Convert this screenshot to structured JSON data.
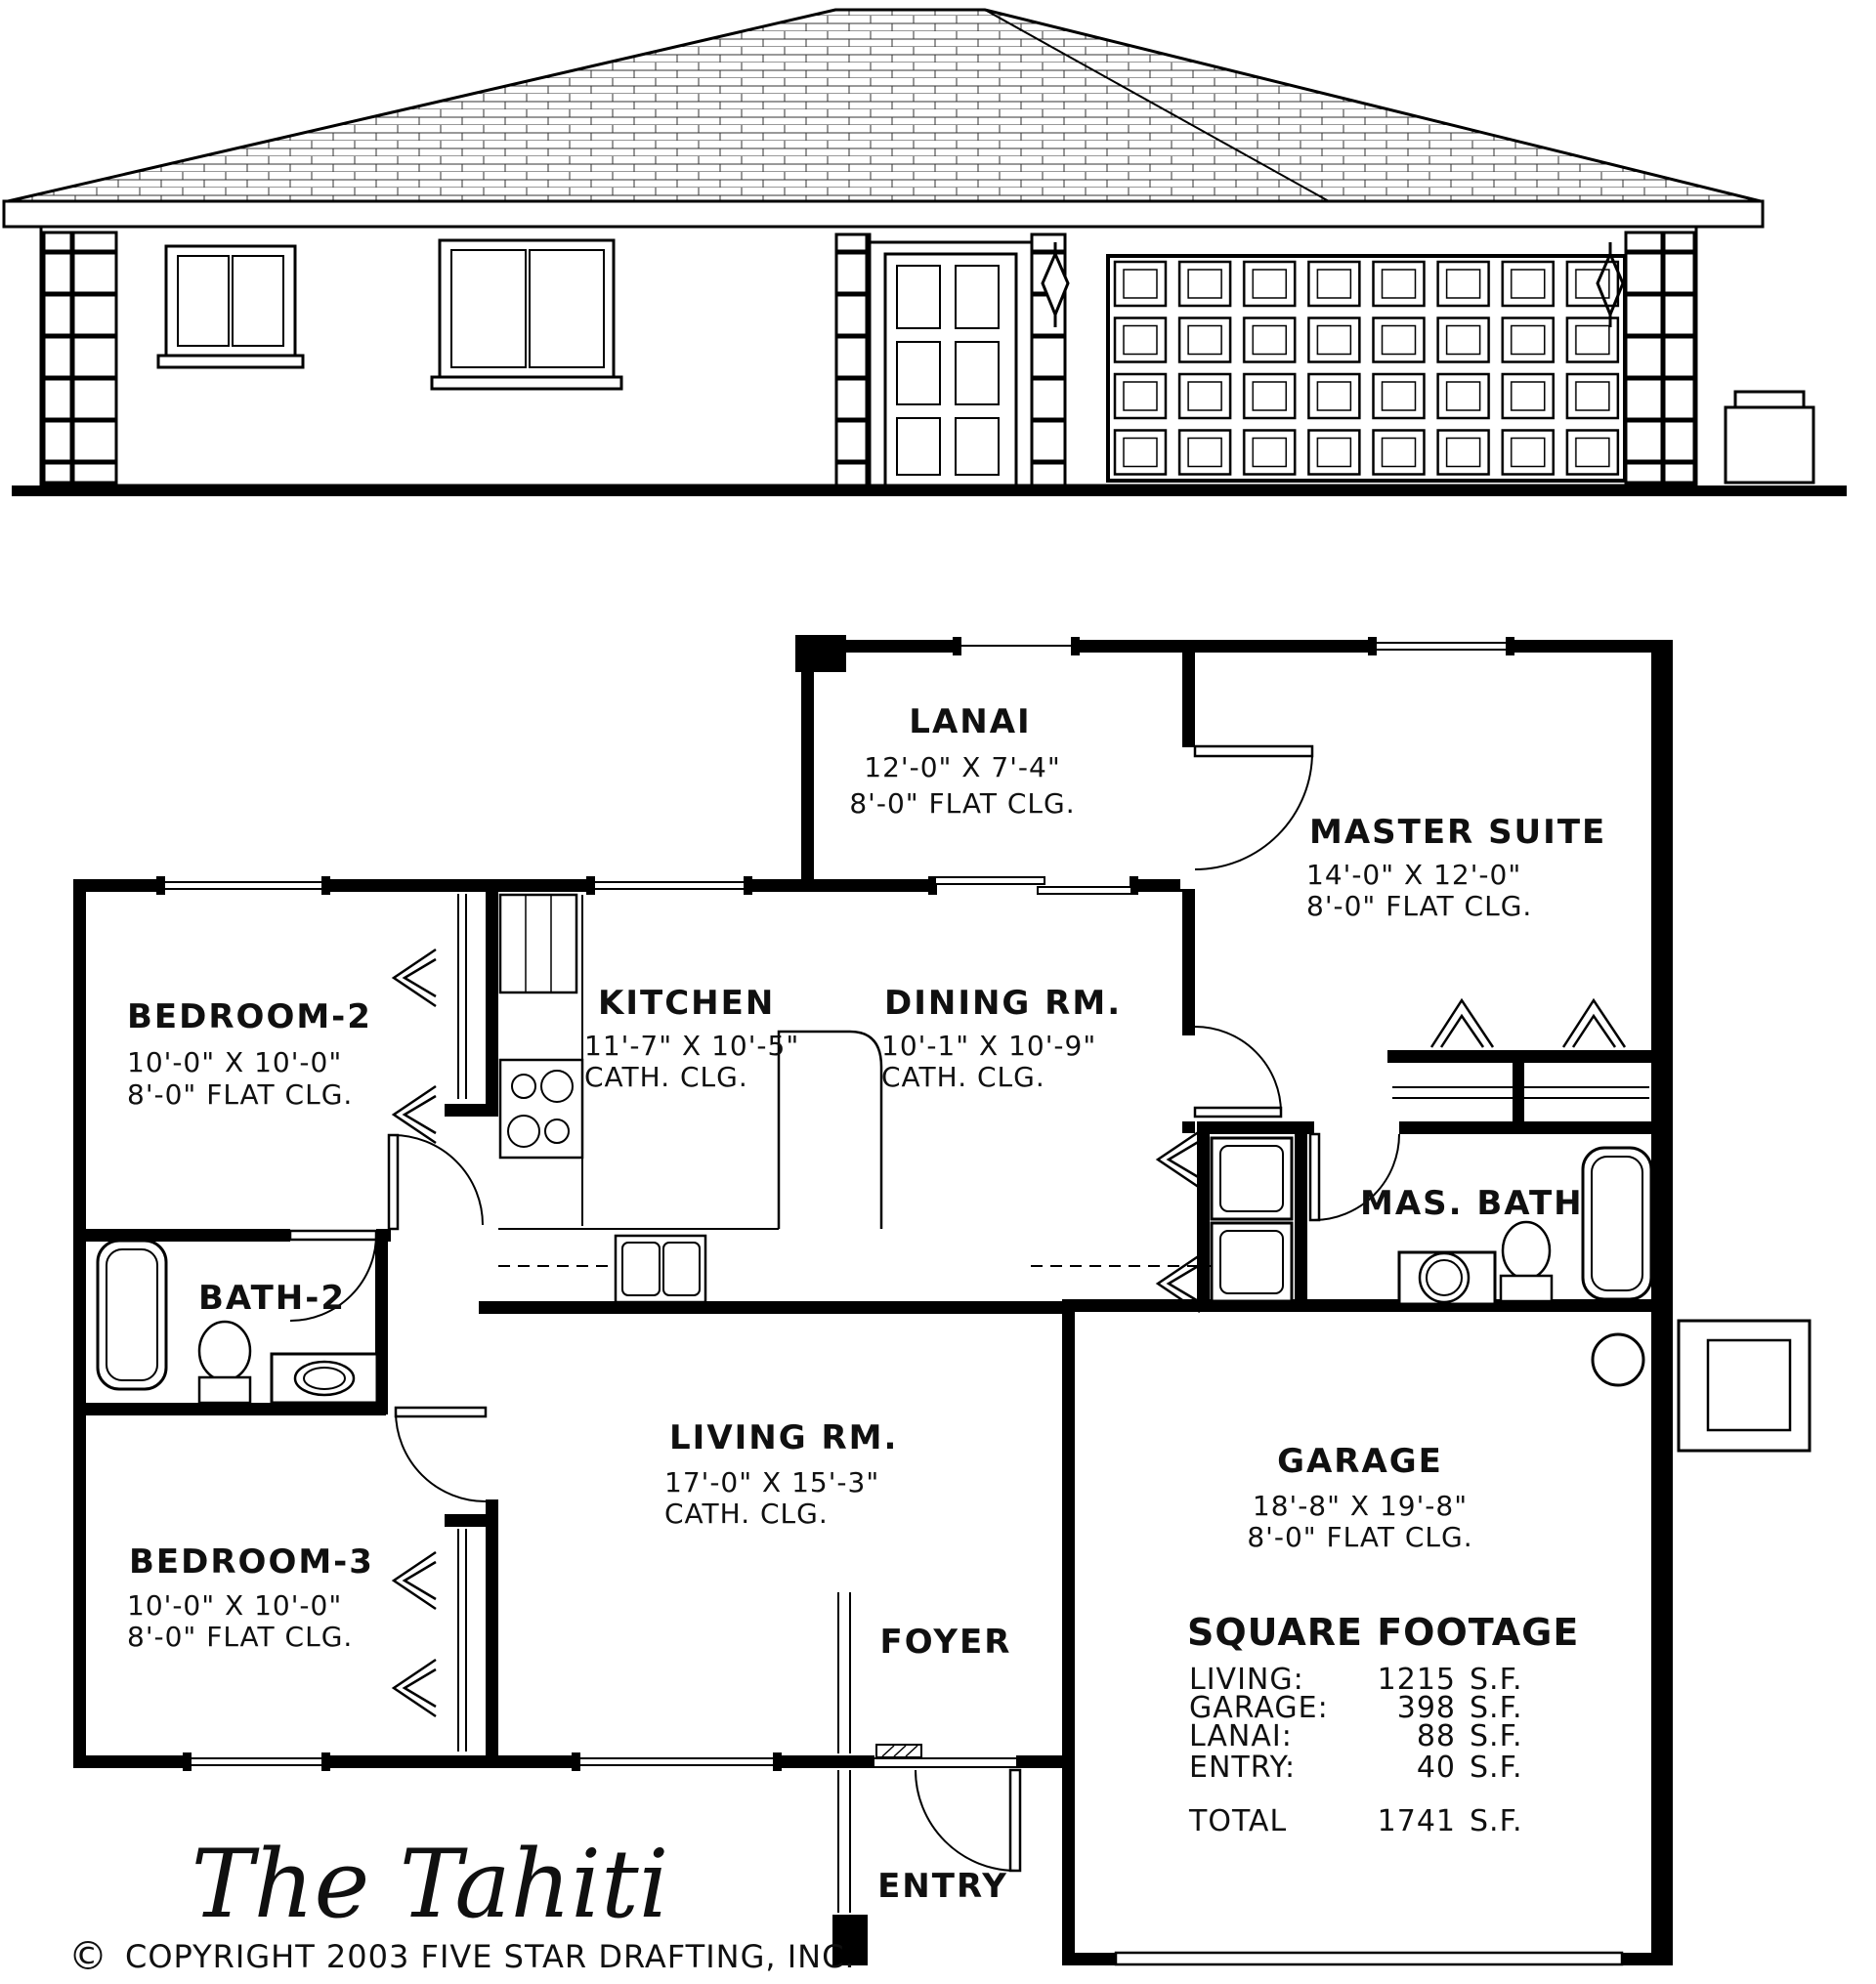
{
  "drawing": {
    "type": "house-plan-sheet",
    "views": [
      "front-elevation",
      "floor-plan"
    ]
  },
  "rooms": [
    {
      "name": "LANAI",
      "dims": "12'-0\" X 7'-4\"",
      "ceiling": "8'-0\" FLAT CLG."
    },
    {
      "name": "MASTER SUITE",
      "dims": "14'-0\" X 12'-0\"",
      "ceiling": "8'-0\" FLAT CLG."
    },
    {
      "name": "BEDROOM-2",
      "dims": "10'-0\" X 10'-0\"",
      "ceiling": "8'-0\" FLAT CLG."
    },
    {
      "name": "KITCHEN",
      "dims": "11'-7\" X 10'-5\"",
      "ceiling": "CATH. CLG."
    },
    {
      "name": "DINING RM.",
      "dims": "10'-1\" X 10'-9\"",
      "ceiling": "CATH. CLG."
    },
    {
      "name": "BATH-2"
    },
    {
      "name": "MAS. BATH"
    },
    {
      "name": "LIVING RM.",
      "dims": "17'-0\" X 15'-3\"",
      "ceiling": "CATH. CLG."
    },
    {
      "name": "BEDROOM-3",
      "dims": "10'-0\" X 10'-0\"",
      "ceiling": "8'-0\" FLAT CLG."
    },
    {
      "name": "GARAGE",
      "dims": "18'-8\" X 19'-8\"",
      "ceiling": "8'-0\" FLAT CLG."
    },
    {
      "name": "FOYER"
    },
    {
      "name": "ENTRY"
    }
  ],
  "square_footage": {
    "title": "SQUARE FOOTAGE",
    "rows": [
      {
        "label": "LIVING:",
        "value": "1215",
        "unit": "S.F."
      },
      {
        "label": "GARAGE:",
        "value": "398",
        "unit": "S.F."
      },
      {
        "label": "LANAI:",
        "value": "88",
        "unit": "S.F."
      },
      {
        "label": "ENTRY:",
        "value": "40",
        "unit": "S.F."
      }
    ],
    "total": {
      "label": "TOTAL",
      "value": "1741",
      "unit": "S.F."
    }
  },
  "titleblock": {
    "plan_name": "The Tahiti",
    "copyright_symbol": "©",
    "copyright": "COPYRIGHT 2003 FIVE STAR DRAFTING, INC."
  }
}
